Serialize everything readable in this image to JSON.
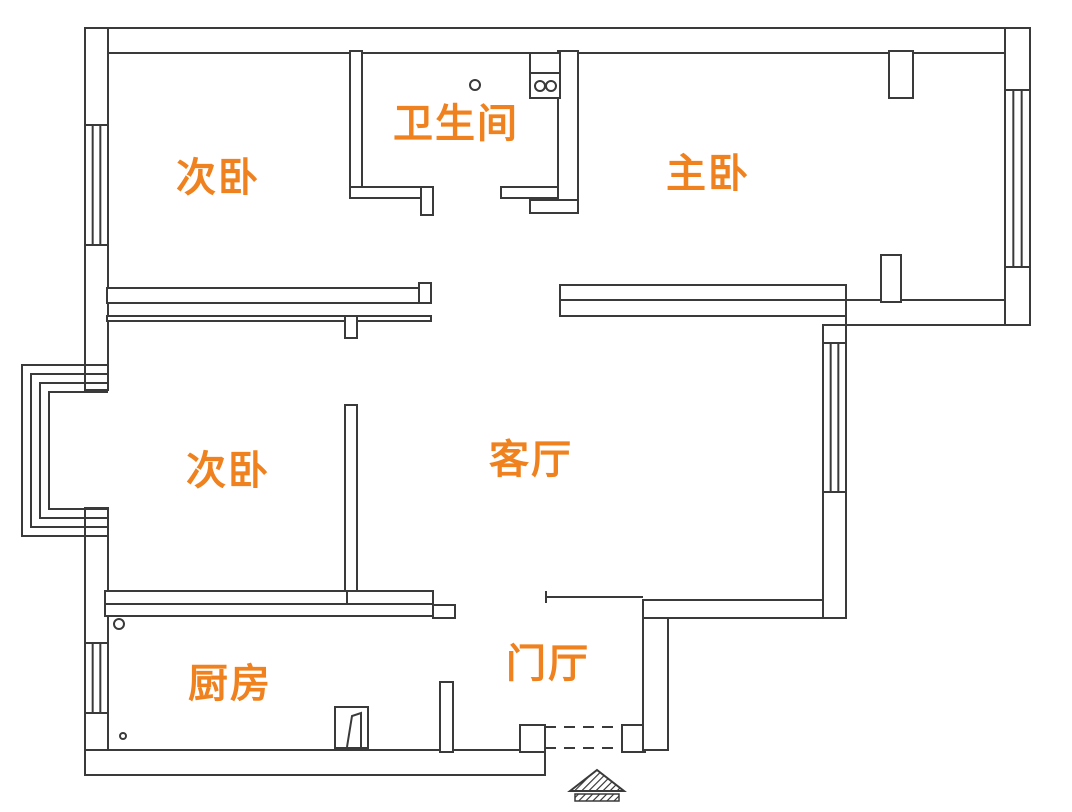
{
  "canvas": {
    "width": 1072,
    "height": 812,
    "background": "#ffffff"
  },
  "style": {
    "line_color": "#3a3a3a",
    "line_width": 2,
    "label_color": "#ef821e",
    "label_font_size": 40,
    "hatch_color": "#2a2a2a"
  },
  "rooms": [
    {
      "name": "room-label-bedroom-top",
      "label": "次卧",
      "x": 218,
      "y": 180
    },
    {
      "name": "room-label-bathroom",
      "label": "卫生间",
      "x": 456,
      "y": 126
    },
    {
      "name": "room-label-master-bedroom",
      "label": "主卧",
      "x": 708,
      "y": 176
    },
    {
      "name": "room-label-bedroom-middle",
      "label": "次卧",
      "x": 228,
      "y": 473
    },
    {
      "name": "room-label-living-room",
      "label": "客厅",
      "x": 531,
      "y": 462
    },
    {
      "name": "room-label-kitchen",
      "label": "厨房",
      "x": 230,
      "y": 686
    },
    {
      "name": "room-label-entry-hall",
      "label": "门厅",
      "x": 548,
      "y": 666
    }
  ],
  "walls": [
    {
      "name": "top-wall",
      "x": 85,
      "y": 28,
      "w": 945,
      "h": 25
    },
    {
      "name": "left-wall-upper",
      "x": 85,
      "y": 28,
      "w": 23,
      "h": 362
    },
    {
      "name": "left-wall-lower",
      "x": 85,
      "y": 508,
      "w": 23,
      "h": 267
    },
    {
      "name": "bottom-wall",
      "x": 85,
      "y": 750,
      "w": 460,
      "h": 25
    },
    {
      "name": "entry-left-jamb",
      "x": 520,
      "y": 725,
      "w": 25,
      "h": 27
    },
    {
      "name": "entry-right-block",
      "x": 622,
      "y": 725,
      "w": 23,
      "h": 27
    },
    {
      "name": "hall-right-wall",
      "x": 643,
      "y": 600,
      "w": 25,
      "h": 150
    },
    {
      "name": "living-bottom-wall",
      "x": 643,
      "y": 600,
      "w": 203,
      "h": 18
    },
    {
      "name": "living-right-wall",
      "x": 823,
      "y": 325,
      "w": 23,
      "h": 293
    },
    {
      "name": "master-bottom-outer-wall",
      "x": 846,
      "y": 300,
      "w": 184,
      "h": 25
    },
    {
      "name": "right-wall",
      "x": 1005,
      "y": 28,
      "w": 25,
      "h": 297
    },
    {
      "name": "bedroom-top-right-wall",
      "x": 350,
      "y": 51,
      "w": 12,
      "h": 146
    },
    {
      "name": "bathroom-bottom-wall-left",
      "x": 350,
      "y": 187,
      "w": 83,
      "h": 11
    },
    {
      "name": "bathroom-door-stub",
      "x": 421,
      "y": 187,
      "w": 12,
      "h": 28
    },
    {
      "name": "bathroom-bottom-wall-right",
      "x": 501,
      "y": 187,
      "w": 57,
      "h": 11
    },
    {
      "name": "bathroom-master-wall",
      "x": 558,
      "y": 51,
      "w": 20,
      "h": 162
    },
    {
      "name": "bathroom-master-wall-foot",
      "x": 530,
      "y": 200,
      "w": 48,
      "h": 13
    },
    {
      "name": "bedroom-top-bottom-wall",
      "x": 107,
      "y": 288,
      "w": 324,
      "h": 15
    },
    {
      "name": "bedroom-top-wall-hook",
      "x": 419,
      "y": 283,
      "w": 12,
      "h": 20
    },
    {
      "name": "corridor-thin-wall",
      "x": 107,
      "y": 316,
      "w": 324,
      "h": 5
    },
    {
      "name": "bedroom-middle-wall-stub",
      "x": 345,
      "y": 316,
      "w": 12,
      "h": 22
    },
    {
      "name": "bedroom-middle-right-wall",
      "x": 345,
      "y": 405,
      "w": 12,
      "h": 200
    },
    {
      "name": "bedroom-middle-bottom-wall",
      "x": 105,
      "y": 591,
      "w": 242,
      "h": 13
    },
    {
      "name": "kitchen-top-wall",
      "x": 105,
      "y": 604,
      "w": 328,
      "h": 12
    },
    {
      "name": "kitchen-top-wall-upper",
      "x": 347,
      "y": 591,
      "w": 86,
      "h": 13
    },
    {
      "name": "kitchen-top-wall-step",
      "x": 433,
      "y": 605,
      "w": 22,
      "h": 13
    },
    {
      "name": "kitchen-right-wall",
      "x": 440,
      "y": 682,
      "w": 13,
      "h": 70
    },
    {
      "name": "master-living-wall",
      "x": 560,
      "y": 285,
      "w": 286,
      "h": 31
    },
    {
      "name": "master-door-pier",
      "x": 881,
      "y": 255,
      "w": 20,
      "h": 47
    },
    {
      "name": "master-top-pier",
      "x": 889,
      "y": 51,
      "w": 24,
      "h": 47
    }
  ],
  "windows": [
    {
      "name": "bedroom-top-left-window",
      "x": 85,
      "y": 125,
      "w": 23,
      "h": 120,
      "orientation": "vertical"
    },
    {
      "name": "kitchen-left-window",
      "x": 85,
      "y": 643,
      "w": 23,
      "h": 70,
      "orientation": "vertical"
    },
    {
      "name": "living-right-window",
      "x": 823,
      "y": 343,
      "w": 23,
      "h": 149,
      "orientation": "vertical"
    },
    {
      "name": "master-right-window",
      "x": 1005,
      "y": 90,
      "w": 25,
      "h": 177,
      "orientation": "vertical"
    }
  ],
  "bay_window": {
    "name": "bay-window",
    "wall_x": 108,
    "lines": [
      {
        "x": 22,
        "y_top": 365,
        "y_bottom": 536
      },
      {
        "x": 31,
        "y_top": 374,
        "y_bottom": 527
      },
      {
        "x": 40,
        "y_top": 383,
        "y_bottom": 518
      },
      {
        "x": 49,
        "y_top": 392,
        "y_bottom": 509
      }
    ]
  },
  "thin_lines": [
    {
      "name": "hall-living-boundary-line",
      "x1": 546,
      "y1": 597,
      "x2": 643,
      "y2": 597
    },
    {
      "name": "hall-living-boundary-tick",
      "x1": 546,
      "y1": 591,
      "x2": 546,
      "y2": 603
    },
    {
      "name": "master-wall-inner-line",
      "x1": 560,
      "y1": 300,
      "x2": 846,
      "y2": 300
    }
  ],
  "circles": [
    {
      "name": "bathroom-drain-circle",
      "cx": 475,
      "cy": 85,
      "r": 5
    },
    {
      "name": "kitchen-circle-large",
      "cx": 119,
      "cy": 624,
      "r": 5
    },
    {
      "name": "kitchen-circle-small",
      "cx": 123,
      "cy": 736,
      "r": 3
    }
  ],
  "sink_unit": {
    "name": "bathroom-sink-unit",
    "rect": {
      "x": 530,
      "y": 53,
      "w": 30,
      "h": 45
    },
    "divider_y": 73,
    "bowls": [
      {
        "cx": 540,
        "cy": 86,
        "r": 5
      },
      {
        "cx": 551,
        "cy": 86,
        "r": 5
      }
    ]
  },
  "kitchen_door_symbol": {
    "name": "kitchen-door-symbol",
    "frame": {
      "x": 335,
      "y": 707,
      "w": 33,
      "h": 41
    },
    "leaf": [
      [
        347,
        747
      ],
      [
        352,
        716
      ],
      [
        361,
        713
      ],
      [
        361,
        747
      ]
    ]
  },
  "entry_door": {
    "name": "entry-door-dashed",
    "dash_pattern": "11 8",
    "lines": [
      {
        "x1": 545,
        "y1": 727,
        "x2": 622,
        "y2": 727
      },
      {
        "x1": 545,
        "y1": 748,
        "x2": 622,
        "y2": 748
      }
    ]
  },
  "entrance_marker": {
    "name": "entrance-arrow-marker",
    "triangle": [
      [
        570,
        791
      ],
      [
        597,
        770
      ],
      [
        624,
        791
      ]
    ],
    "bar": {
      "x": 575,
      "y": 794,
      "w": 44,
      "h": 7
    }
  }
}
